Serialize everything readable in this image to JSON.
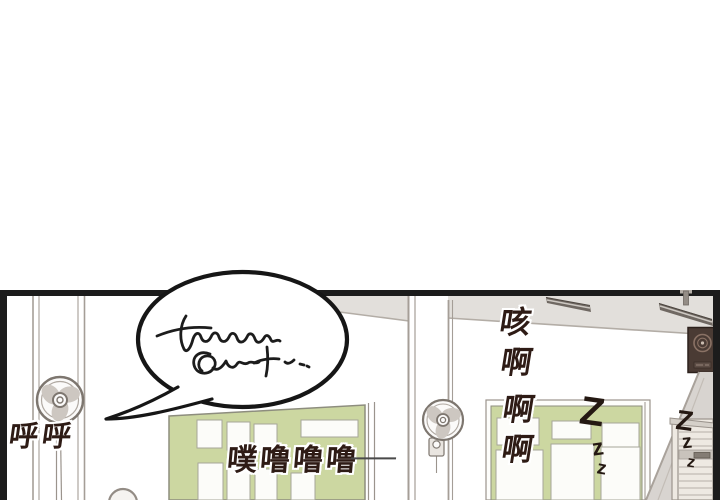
{
  "comic": {
    "kind": "webtoon-panel",
    "sfx": {
      "breath": "呼呼",
      "cough": [
        "咳",
        "啊",
        "啊",
        "啊"
      ],
      "slurp": "噗噜噜噜",
      "slurp_dash": "—",
      "sleep_left": [
        "Z",
        "z",
        "z"
      ],
      "sleep_right": [
        "Z",
        "z",
        "z"
      ]
    },
    "speech_bubble": {
      "content": "illegible handwritten scribble"
    },
    "colors": {
      "panel_border": "#1c1c1c",
      "door_green": "#ccd7a1",
      "ceiling_gray": "#e2dfdb",
      "shadow_gray": "#d8d4d0",
      "speaker_brown": "#4a3b34",
      "sfx_text": "#2e1b15",
      "line_gray": "#a59e97"
    }
  }
}
